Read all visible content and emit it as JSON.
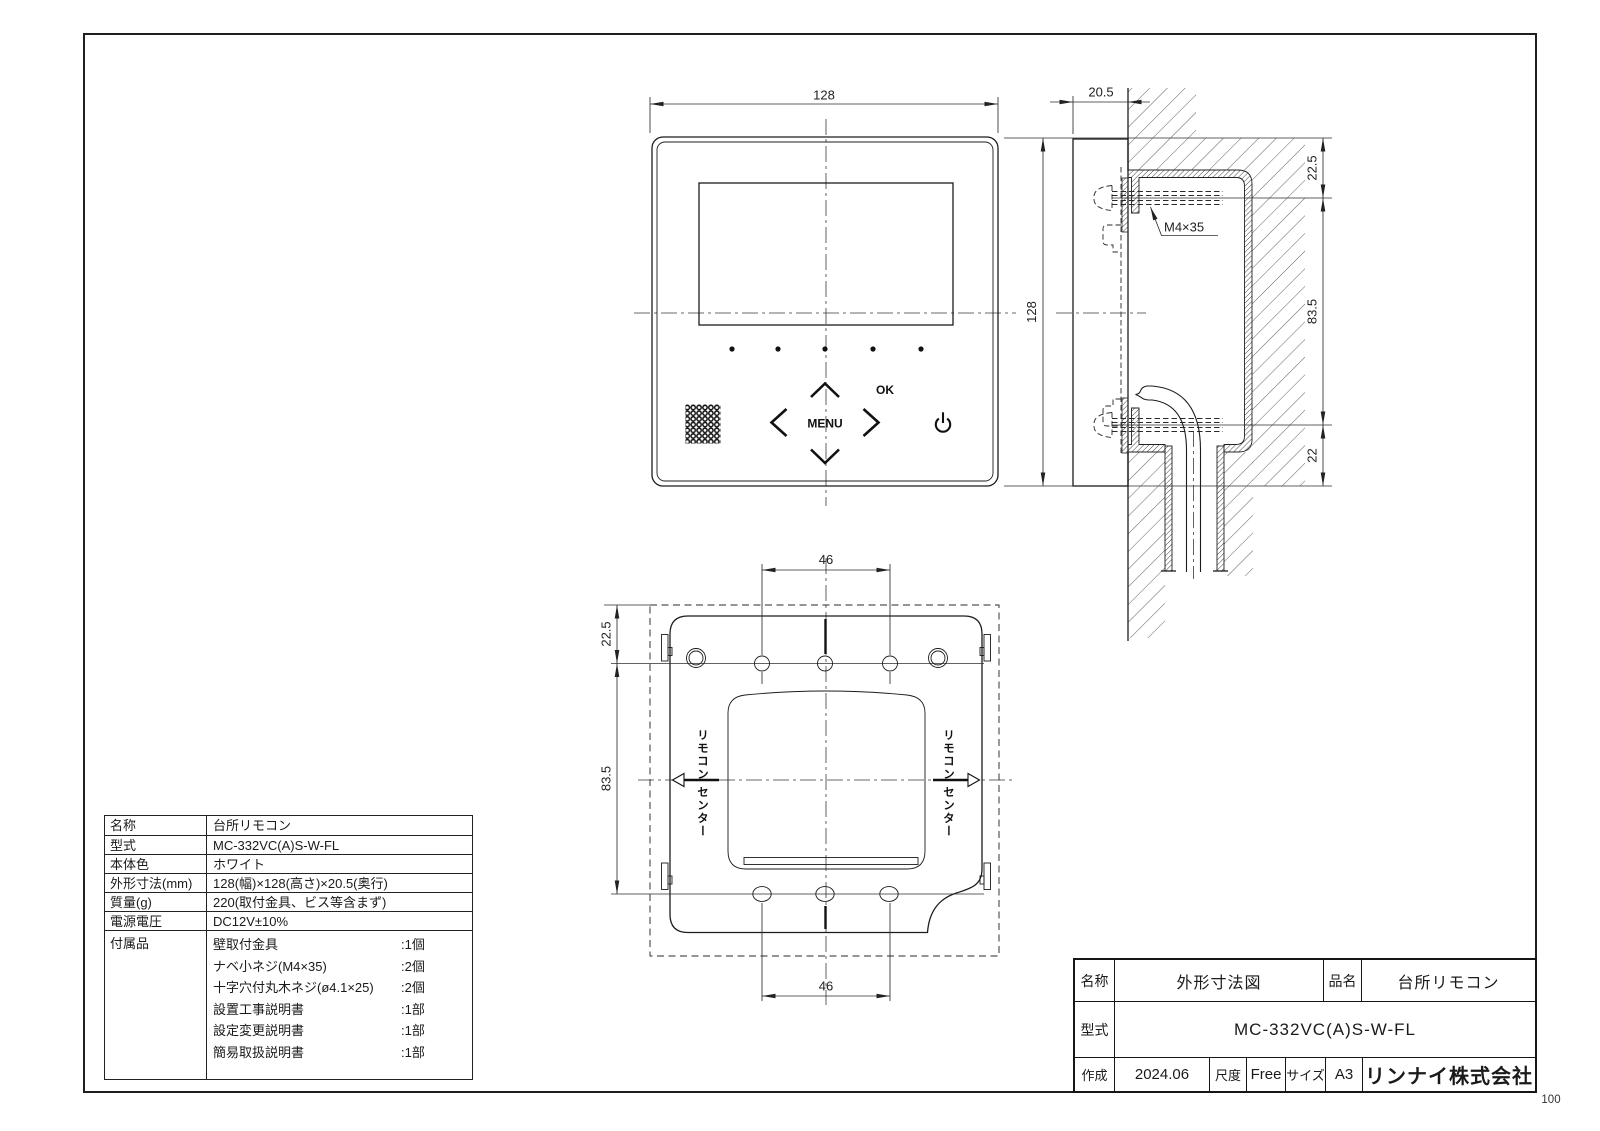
{
  "page": {
    "number": "100"
  },
  "front_view": {
    "dim_width": "128",
    "dim_height": "128",
    "menu_label": "MENU",
    "ok_label": "OK"
  },
  "side_view": {
    "dim_depth": "20.5",
    "screw_label": "M4×35",
    "dim_top": "22.5",
    "dim_middle": "83.5",
    "dim_bottom": "22"
  },
  "plate_view": {
    "dim_top_holes": "46",
    "dim_bottom_holes": "46",
    "dim_edge_to_holes": "22.5",
    "dim_holes_span": "83.5",
    "center_left_1": "リモコン",
    "center_left_2": "センター",
    "center_right_1": "リモコン",
    "center_right_2": "センター"
  },
  "spec_table": {
    "rows": [
      {
        "label": "名称",
        "value": "台所リモコン"
      },
      {
        "label": "型式",
        "value": "MC-332VC(A)S-W-FL"
      },
      {
        "label": "本体色",
        "value": "ホワイト"
      },
      {
        "label": "外形寸法(mm)",
        "value": "128(幅)×128(高さ)×20.5(奥行)"
      },
      {
        "label": "質量(g)",
        "value": "220(取付金具、ビス等含まず)"
      },
      {
        "label": "電源電圧",
        "value": "DC12V±10%"
      }
    ],
    "accessories_label": "付属品",
    "accessories": [
      {
        "name": "壁取付金具",
        "qty": ":1個"
      },
      {
        "name": "ナベ小ネジ(M4×35)",
        "qty": ":2個"
      },
      {
        "name": "十字穴付丸木ネジ(ø4.1×25)",
        "qty": ":2個"
      },
      {
        "name": "設置工事説明書",
        "qty": ":1部"
      },
      {
        "name": "設定変更説明書",
        "qty": ":1部"
      },
      {
        "name": "簡易取扱説明書",
        "qty": ":1部"
      }
    ]
  },
  "title_block": {
    "name_label": "名称",
    "name_value": "外形寸法図",
    "product_label": "品名",
    "product_value": "台所リモコン",
    "model_label": "型式",
    "model_value": "MC-332VC(A)S-W-FL",
    "created_label": "作成",
    "created_value": "2024.06",
    "scale_label": "尺度",
    "scale_value": "Free",
    "size_label": "サイズ",
    "size_value": "A3",
    "company": "リンナイ株式会社"
  }
}
